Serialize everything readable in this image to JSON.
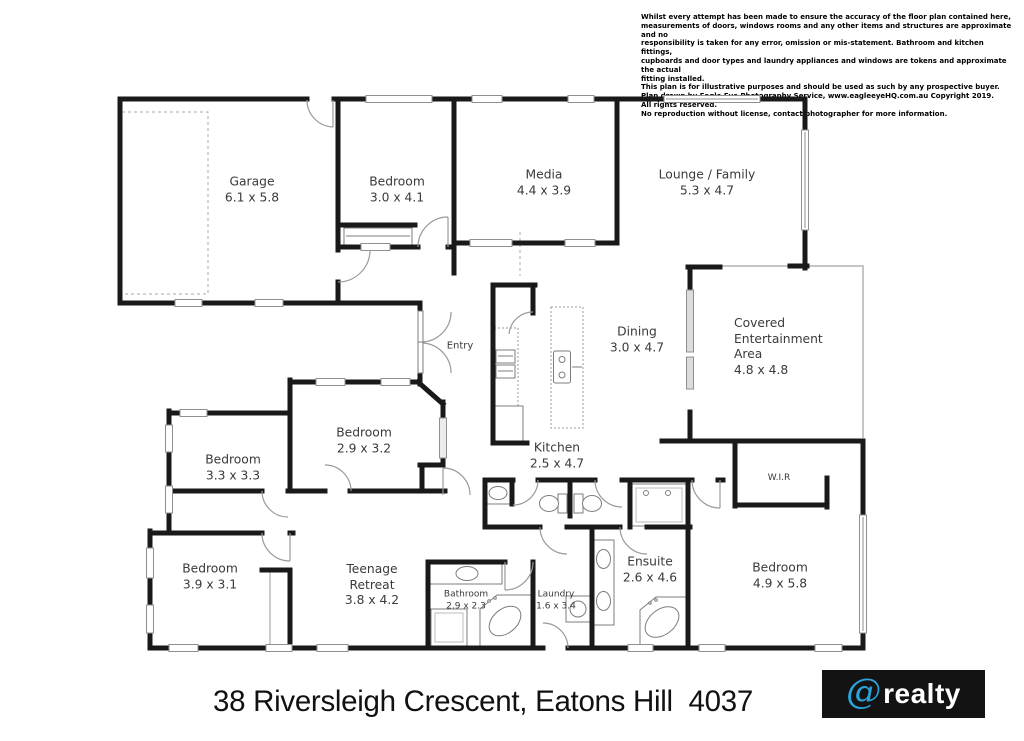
{
  "disclaimer": {
    "text": "Whilst every attempt has been made to ensure the accuracy of the floor plan contained here,\nmeasurements of doors, windows rooms and any other items and structures are approximate and no\nresponsibility is taken for any error, omission or mis-statement. Bathroom and kitchen fittings,\ncupboards and door types and laundry appliances and windows are tokens and approximate the actual\nfitting installed.\nThis plan is for illustrative purposes and should be used as such by any prospective buyer.\nPlan drawn by Eagle Eye Photography Service, www.eagleeyeHQ.com.au Copyright 2019.\nAll rights reserved.\nNo reproduction without license, contact photographer for more information."
  },
  "plan": {
    "rooms": [
      {
        "id": "garage",
        "name": "Garage",
        "dims": "6.1 x 5.8"
      },
      {
        "id": "bedroom-front",
        "name": "Bedroom",
        "dims": "3.0 x 4.1"
      },
      {
        "id": "media",
        "name": "Media",
        "dims": "4.4 x 3.9"
      },
      {
        "id": "lounge-family",
        "name": "Lounge / Family",
        "dims": "5.3 x 4.7"
      },
      {
        "id": "dining",
        "name": "Dining",
        "dims": "3.0 x 4.7"
      },
      {
        "id": "covered-entertainment",
        "name": "Covered\nEntertainment\nArea",
        "dims": "4.8 x 4.8"
      },
      {
        "id": "kitchen",
        "name": "Kitchen",
        "dims": "2.5 x 4.7"
      },
      {
        "id": "bedroom-mid",
        "name": "Bedroom",
        "dims": "2.9 x 3.2"
      },
      {
        "id": "bedroom-left",
        "name": "Bedroom",
        "dims": "3.3 x 3.3"
      },
      {
        "id": "bedroom-lower-left",
        "name": "Bedroom",
        "dims": "3.9 x 3.1"
      },
      {
        "id": "teenage-retreat",
        "name": "Teenage\nRetreat",
        "dims": "3.8 x 4.2"
      },
      {
        "id": "bathroom",
        "name": "Bathroom",
        "dims": "2.9 x 2.3"
      },
      {
        "id": "laundry",
        "name": "Laundry",
        "dims": "1.6 x 3.4"
      },
      {
        "id": "ensuite",
        "name": "Ensuite",
        "dims": "2.6 x 4.6"
      },
      {
        "id": "bedroom-master",
        "name": "Bedroom",
        "dims": "4.9 x 5.8"
      }
    ],
    "labels": {
      "entry": "Entry",
      "wir": "W.I.R"
    }
  },
  "footer": {
    "address": "38 Riversleigh Crescent, Eatons Hill  4037"
  },
  "logo": {
    "symbol": "@",
    "text": "realty",
    "bg": "#131313",
    "symbol_color": "#2ba4dc",
    "text_color": "#ffffff"
  },
  "colors": {
    "wall": "#191919",
    "window_outline": "#8f8f8f",
    "door_arc": "#9a9a9a",
    "outdoor_line": "#c6c6c6"
  }
}
